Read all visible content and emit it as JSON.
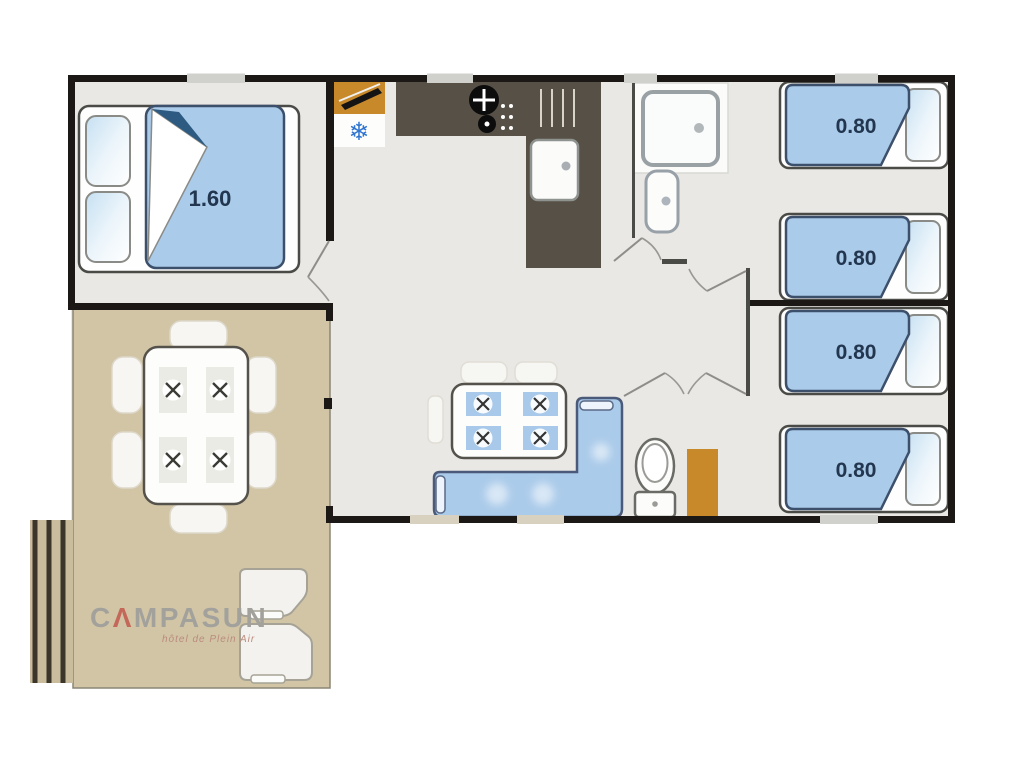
{
  "document": {
    "type": "floor-plan",
    "subject": "mobile home with covered terrace, 3 bedrooms, kitchen, shower room and WC"
  },
  "branding": {
    "logo_part1": "C",
    "logo_tent_glyph": "Λ",
    "logo_part2": "MPASUN",
    "logo_tagline": "hôtel de Plein Air"
  },
  "dimension_labels": {
    "master_bed_width": "1.60",
    "single_bed_widths": [
      {
        "label": "0.80"
      },
      {
        "label": "0.80"
      },
      {
        "label": "0.80"
      },
      {
        "label": "0.80"
      }
    ]
  },
  "icons": {
    "freezer_snowflake": "❄"
  },
  "colors": {
    "wall": "#1b1815",
    "inner_wall": "#4a4a46",
    "floor": "#e9e8e5",
    "terrace": "#d1c5a6",
    "bed_blue": "#abcbea",
    "bed_edge": "#3c4f6b",
    "sofa_blue": "#abcbea",
    "cabinet_orange": "#c8892b",
    "counter": "#575046",
    "snowflake": "#2f74d0",
    "label_text": "#22364f",
    "logo_gray": "#a3a19c",
    "logo_red": "#c4685a",
    "fold_dark": "#2c5a80"
  }
}
